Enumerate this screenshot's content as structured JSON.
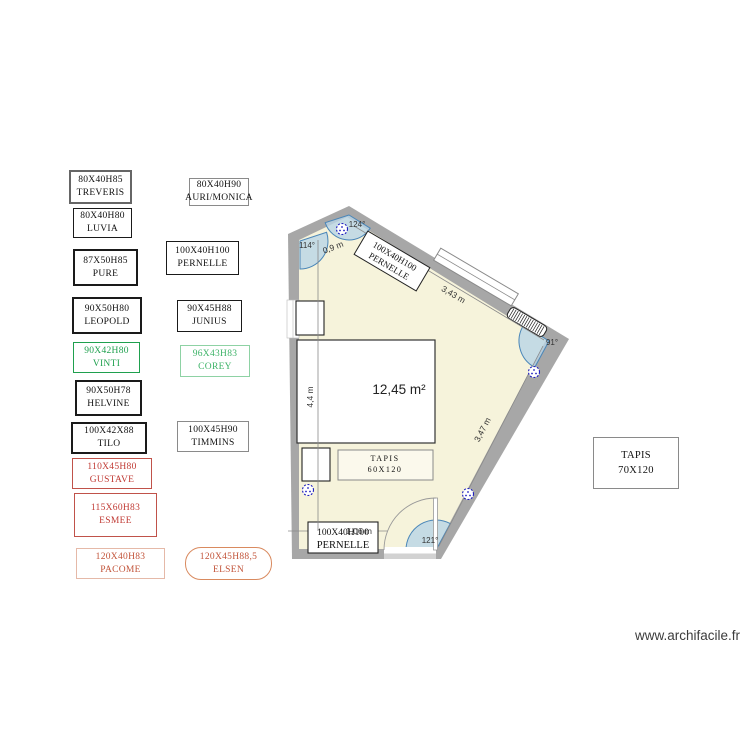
{
  "watermark": "www.archifacile.fr",
  "colors": {
    "wall": "#a7a7a7",
    "floor": "#f6f3db",
    "angle_fill": "#b9d5e6",
    "angle_stroke": "#4a86b8",
    "outlet": "#2020c0",
    "green": "#1fa04e",
    "light_green_border": "#8ed2a4",
    "light_green_text": "#3eb368",
    "red": "#c03a34",
    "orange_text": "#c2543a",
    "orange_border_light": "#e5b9a8",
    "orange_border": "#d98a5f"
  },
  "legend": {
    "treveris": {
      "dims": "80X40H85",
      "name": "TREVERIS"
    },
    "auri": {
      "dims": "80X40H90",
      "name": "AURI/MONICA"
    },
    "luvia": {
      "dims": "80X40H80",
      "name": "LUVIA"
    },
    "pure": {
      "dims": "87X50H85",
      "name": "PURE"
    },
    "pernelle": {
      "dims": "100X40H100",
      "name": "PERNELLE"
    },
    "leopold": {
      "dims": "90X50H80",
      "name": "LEOPOLD"
    },
    "junius": {
      "dims": "90X45H88",
      "name": "JUNIUS"
    },
    "vinti": {
      "dims": "90X42H80",
      "name": "VINTI",
      "color": "#1fa04e",
      "border_color": "#1fa04e"
    },
    "corey": {
      "dims": "96X43H83",
      "name": "COREY",
      "color": "#3eb368",
      "border_color": "#8ed2a4"
    },
    "helvine": {
      "dims": "90X50H78",
      "name": "HELVINE"
    },
    "tilo": {
      "dims": "100X42X88",
      "name": "TILO"
    },
    "timmins": {
      "dims": "100X45H90",
      "name": "TIMMINS"
    },
    "gustave": {
      "dims": "110X45H80",
      "name": "GUSTAVE",
      "color": "#c03a34",
      "border_color": "#c0524a"
    },
    "esmee": {
      "dims": "115X60H83",
      "name": "ESMEE",
      "color": "#c03a34",
      "border_color": "#c0524a"
    },
    "pacome": {
      "dims": "120X40H83",
      "name": "PACOME",
      "color": "#c2543a",
      "border_color": "#e5b9a8"
    },
    "elsen": {
      "dims": "120X45H88,5",
      "name": "ELSEN",
      "color": "#c2543a",
      "border_color": "#d98a5f"
    }
  },
  "rug_outside": {
    "line1": "TAPIS",
    "line2": "70X120"
  },
  "plan": {
    "area": "12,45 m²",
    "angles": {
      "a114": "114°",
      "a124": "124°",
      "a91": "91°",
      "a121": "121°"
    },
    "dims": {
      "d09": "0,9 m",
      "d343": "3,43 m",
      "d44": "4,4 m",
      "d347": "3,47 m",
      "d106": "1,06 m"
    },
    "pernelle_top": {
      "line1": "100X40H100",
      "line2": "PERNELLE"
    },
    "pernelle_bottom": {
      "line1": "100X40H100",
      "line2": "PERNELLE"
    },
    "rug": {
      "line1": "TAPIS",
      "line2": "60X120"
    }
  }
}
